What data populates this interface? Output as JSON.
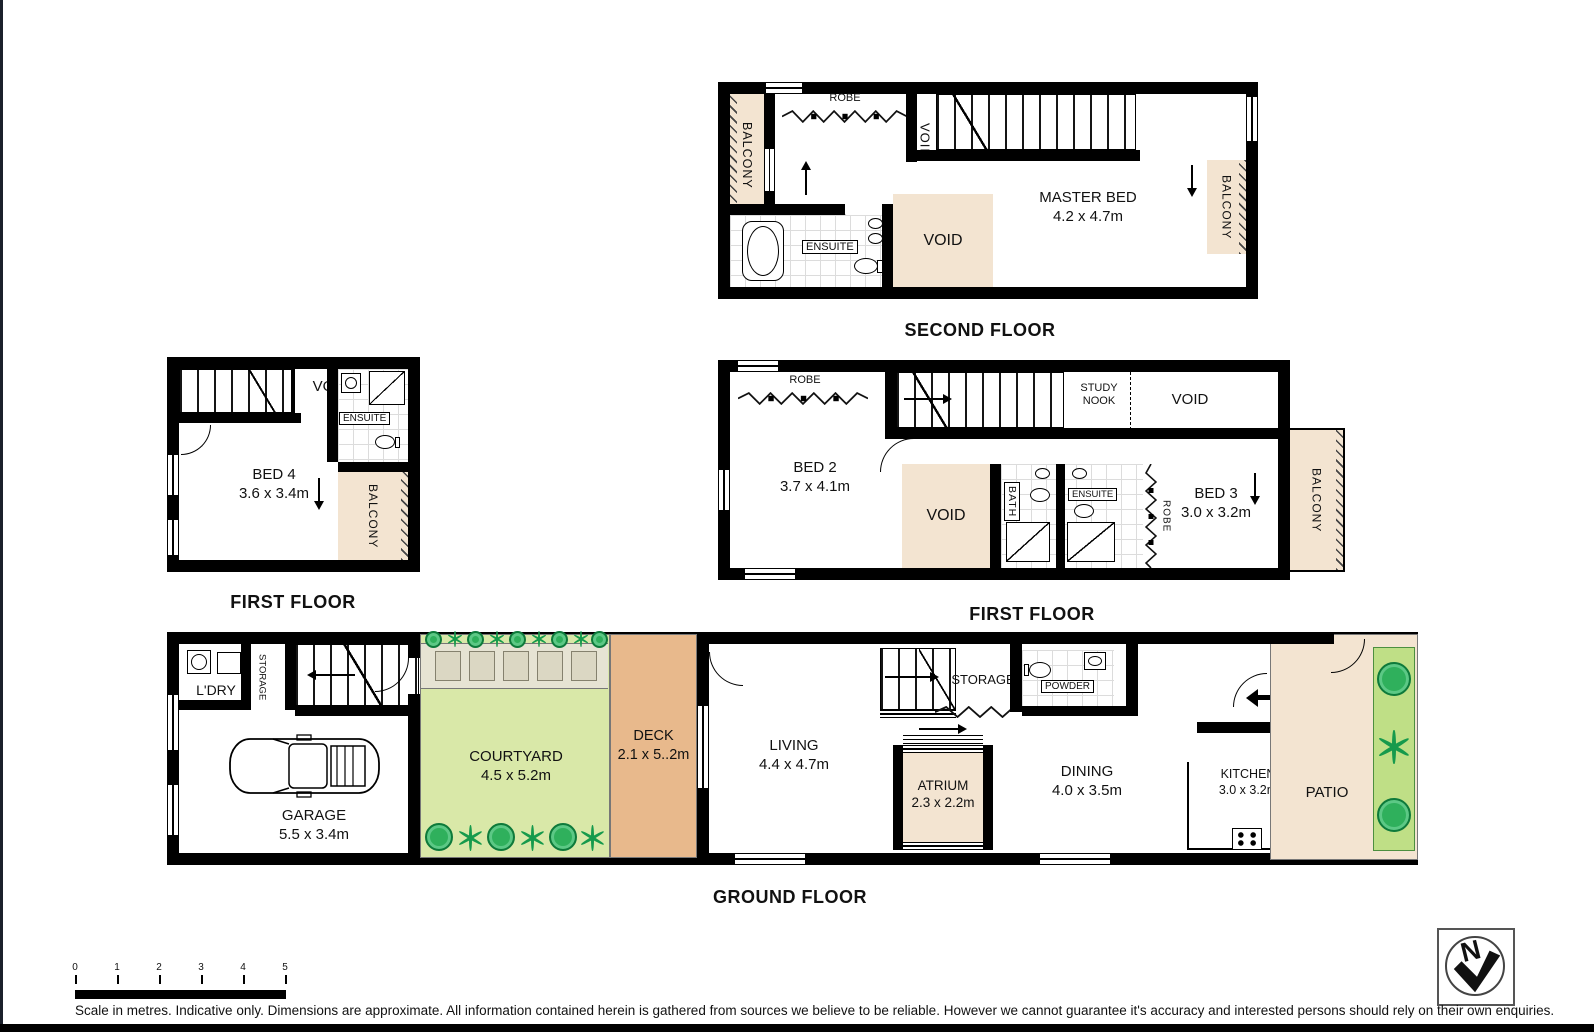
{
  "floors": {
    "second": {
      "label": "SECOND FLOOR"
    },
    "first_left": {
      "label": "FIRST FLOOR"
    },
    "first_right": {
      "label": "FIRST FLOOR"
    },
    "ground": {
      "label": "GROUND FLOOR"
    }
  },
  "terms": {
    "balcony": "BALCONY",
    "void": "VOID",
    "robe": "ROBE",
    "ensuite": "ENSUITE",
    "storage": "STORAGE",
    "bath": "BATH",
    "powder": "POWDER",
    "study_nook": "STUDY NOOK",
    "ldry": "L'DRY",
    "fridge": "F"
  },
  "rooms": {
    "master_bed": {
      "name": "MASTER BED",
      "dims": "4.2 x 4.7m"
    },
    "bed4": {
      "name": "BED 4",
      "dims": "3.6 x 3.4m"
    },
    "bed2": {
      "name": "BED 2",
      "dims": "3.7 x 4.1m"
    },
    "bed3": {
      "name": "BED 3",
      "dims": "3.0 x 3.2m"
    },
    "garage": {
      "name": "GARAGE",
      "dims": "5.5 x 3.4m"
    },
    "courtyard": {
      "name": "COURTYARD",
      "dims": "4.5 x 5.2m"
    },
    "deck": {
      "name": "DECK",
      "dims": "2.1 x 5..2m"
    },
    "living": {
      "name": "LIVING",
      "dims": "4.4 x 4.7m"
    },
    "atrium": {
      "name": "ATRIUM",
      "dims": "2.3 x 2.2m"
    },
    "dining": {
      "name": "DINING",
      "dims": "4.0 x 3.5m"
    },
    "kitchen": {
      "name": "KITCHEN",
      "dims": "3.0 x 3.2m"
    },
    "patio": {
      "name": "PATIO"
    }
  },
  "scale": {
    "ticks": [
      "0",
      "1",
      "2",
      "3",
      "4",
      "5"
    ]
  },
  "compass": {
    "north": "N"
  },
  "disclaimer": "Scale in metres. Indicative only. Dimensions are approximate. All information contained herein is gathered from sources we believe to be reliable. However we cannot guarantee it's accuracy and interested persons should rely on their own enquiries.",
  "colors": {
    "wall": "#000000",
    "balcony_fill": "#f3e4d1",
    "deck_fill": "#e8b98c",
    "courtyard_fill": "#d9e8a8",
    "garden_bed_fill": "#e6e3d3",
    "plant_green": "#2fb05c"
  }
}
